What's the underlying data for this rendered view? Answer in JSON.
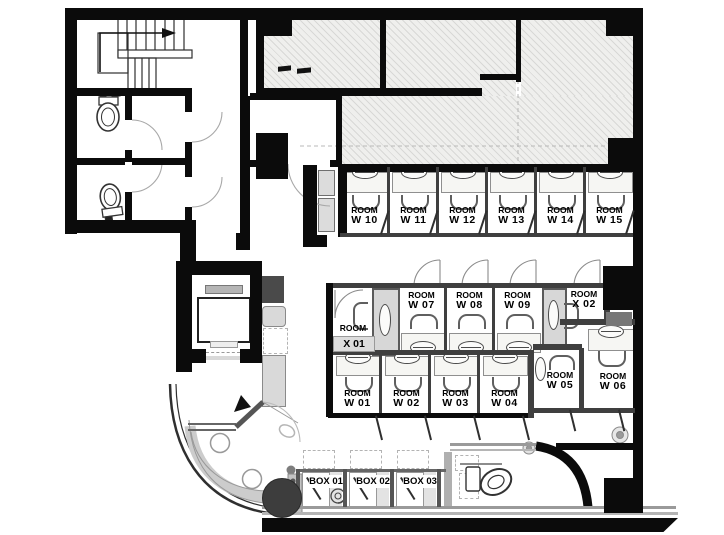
{
  "floor_plan": {
    "rooms_top": [
      {
        "l1": "ROOM",
        "l2": "W 10"
      },
      {
        "l1": "ROOM",
        "l2": "W 11"
      },
      {
        "l1": "ROOM",
        "l2": "W 12"
      },
      {
        "l1": "ROOM",
        "l2": "W 13"
      },
      {
        "l1": "ROOM",
        "l2": "W 14"
      },
      {
        "l1": "ROOM",
        "l2": "W 15"
      }
    ],
    "rooms_mid": [
      {
        "l1": "ROOM",
        "l2": "W 07"
      },
      {
        "l1": "ROOM",
        "l2": "W 08"
      },
      {
        "l1": "ROOM",
        "l2": "W 09"
      }
    ],
    "rooms_bottom": [
      {
        "l1": "ROOM",
        "l2": "W 01"
      },
      {
        "l1": "ROOM",
        "l2": "W 02"
      },
      {
        "l1": "ROOM",
        "l2": "W 03"
      },
      {
        "l1": "ROOM",
        "l2": "W 04"
      }
    ],
    "rooms_right": [
      {
        "l1": "ROOM",
        "l2": "W 05"
      },
      {
        "l1": "ROOM",
        "l2": "W 06"
      }
    ],
    "room_x01": {
      "l1": "ROOM",
      "l2": "X 01"
    },
    "room_x02": {
      "l1": "ROOM",
      "l2": "X 02"
    },
    "booths": [
      {
        "label": "BOX 01"
      },
      {
        "label": "BOX 02"
      },
      {
        "label": "BOX 03"
      }
    ],
    "colors": {
      "wall": "#0b0b0b",
      "hatch_fill": "#efefed",
      "utility_panel": "#d7d7d7",
      "bench": "#cccccc",
      "round_table_dark": "#3d3d3d"
    }
  }
}
